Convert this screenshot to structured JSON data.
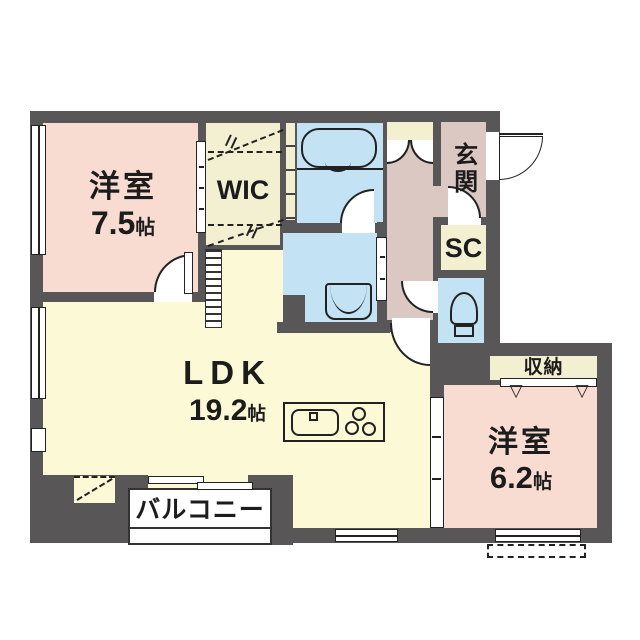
{
  "rooms": {
    "bedroom1": {
      "name": "洋室",
      "area": "7.5",
      "unit": "帖"
    },
    "bedroom2": {
      "name": "洋室",
      "area": "6.2",
      "unit": "帖"
    },
    "ldk": {
      "name": "LDK",
      "area": "19.2",
      "unit": "帖"
    },
    "wic": {
      "name": "WIC"
    },
    "entrance": {
      "name": "玄関"
    },
    "shoe_closet": {
      "name": "SC"
    },
    "storage": {
      "name": "収納"
    },
    "balcony": {
      "name": "バルコニー"
    }
  },
  "colors": {
    "wall": "#585656",
    "bedroom_pink": "#f8dcd1",
    "hall_mauve": "#dbc8c3",
    "wet_area_blue": "#c3e2f4",
    "ldk_cream": "#fbf9d6",
    "closet_cream": "#f3f0d2",
    "balcony_white": "#ffffff"
  }
}
